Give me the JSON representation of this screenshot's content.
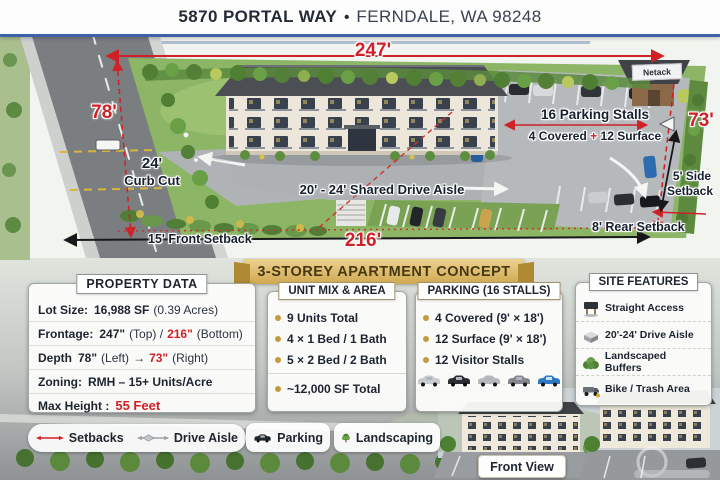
{
  "colors": {
    "accent_red": "#cf2127",
    "ribbon_gold": "#d0a951",
    "banner_blue": "#3d62a8",
    "text_dark": "#1d2430",
    "grass_green": "#8cb565",
    "asphalt_gray": "#b6b9bc"
  },
  "banner": {
    "address": "5870 PORTAL WAY",
    "separator": "•",
    "city": "FERNDALE, WA 98248"
  },
  "site_plan": {
    "dim_top": "247'",
    "dim_left": "78'",
    "dim_right": "73'",
    "dim_bottom": "216'",
    "curb_cut_value": "24'",
    "curb_cut_label": "Curb Cut",
    "shared_drive_aisle": "20' - 24' Shared Drive Aisle",
    "parking_stalls_title": "16 Parking Stalls",
    "parking_covered": "4 Covered",
    "parking_plus": "+",
    "parking_surface": "12 Surface",
    "front_setback": "15' Front Setback",
    "rear_setback": "8' Rear Setback",
    "side_setback_line1": "5' Side",
    "side_setback_line2": "Setback",
    "hut_sign": "Netack"
  },
  "ribbon": {
    "title": "3-STOREY APARTMENT CONCEPT"
  },
  "property_data": {
    "title": "PROPERTY DATA",
    "lot_size": {
      "label": "Lot Size:",
      "value": "16,988 SF",
      "note": "(0.39 Acres)"
    },
    "frontage": {
      "label": "Frontage:",
      "top_value": "247\"",
      "top_note": "(Top) /",
      "bottom_value": "216\"",
      "bottom_note": "(Bottom)"
    },
    "depth": {
      "label": "Depth",
      "left_value": "78\"",
      "left_note": "(Left)",
      "arrow": "→",
      "right_value": "73\"",
      "right_note": "(Right)"
    },
    "zoning": {
      "label": "Zoning:",
      "value": "RMH – 15+ Units/Acre"
    },
    "max_height": {
      "label": "Max Height :",
      "value": "55 Feet"
    }
  },
  "unit_mix": {
    "title": "UNIT MIX & AREA",
    "items": [
      "9 Units Total",
      "4 × 1 Bed / 1 Bath",
      "5 × 2 Bed / 2 Bath"
    ],
    "total": "~12,000 SF Total"
  },
  "parking_panel": {
    "title": "PARKING (16 STALLS)",
    "items": [
      "4 Covered (9' × 18')",
      "12 Surface (9' × 18')",
      "12 Visitor Stalls"
    ]
  },
  "site_features": {
    "title": "SITE FEATURES",
    "items": [
      {
        "icon": "billboard-icon",
        "label": "Straight Access"
      },
      {
        "icon": "planter-icon",
        "label": "20'-24' Drive Aisle"
      },
      {
        "icon": "shrub-icon",
        "label": "Landscaped Buffers"
      },
      {
        "icon": "truck-icon",
        "label": "Bike / Trash Area"
      }
    ]
  },
  "legend": {
    "items": [
      {
        "icon": "setback-line-icon",
        "label": "Setbacks"
      },
      {
        "icon": "drive-aisle-arrow-icon",
        "label": "Drive Aisle"
      },
      {
        "icon": "car-icon",
        "label": "Parking"
      },
      {
        "icon": "tree-icon",
        "label": "Landscaping"
      }
    ]
  },
  "front_view": {
    "label": "Front View"
  }
}
